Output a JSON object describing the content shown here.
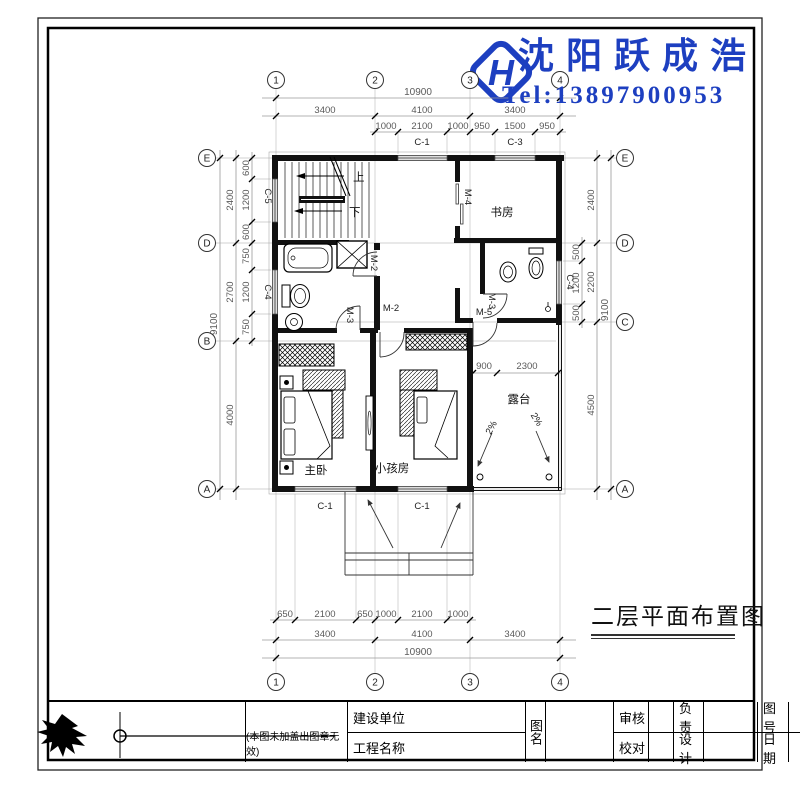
{
  "brand": {
    "name": "沈阳跃成浩",
    "tel": "Tel:13897900953",
    "logo_letter": "H"
  },
  "drawing_title": "二层平面布置图",
  "axes": {
    "cols": [
      "1",
      "2",
      "3",
      "4"
    ],
    "rows_left": [
      "E",
      "D",
      "B",
      "A"
    ],
    "rows_right": [
      "E",
      "D",
      "C",
      "A"
    ]
  },
  "dims": {
    "top": {
      "overall": "10900",
      "spans": [
        "3400",
        "4100",
        "3400"
      ],
      "details": [
        "1000",
        "2100",
        "1000",
        "950",
        "1500",
        "950"
      ]
    },
    "bottom": {
      "overall": "10900",
      "spans": [
        "3400",
        "4100",
        "3400"
      ],
      "details": [
        "650",
        "2100",
        "650",
        "1000",
        "2100",
        "1000"
      ]
    },
    "left": {
      "overall": "9100",
      "spans": [
        "2400",
        "2700",
        "4000"
      ],
      "details": [
        "600",
        "1200",
        "600",
        "750",
        "1200",
        "750"
      ]
    },
    "right": {
      "overall": "9100",
      "spans": [
        "2400",
        "2200",
        "4500"
      ],
      "details": [
        "500",
        "1200",
        "500"
      ]
    },
    "terrace": [
      "900",
      "2300"
    ]
  },
  "windows": {
    "c1": "C-1",
    "c3": "C-3",
    "c4": "C-4",
    "c5": "C-5"
  },
  "doors": {
    "m2": "M-2",
    "m3": "M-3",
    "m4": "M-4",
    "m5": "M-5"
  },
  "rooms": {
    "study": "书房",
    "master": "主卧",
    "kids": "小孩房",
    "terrace": "露台"
  },
  "stair": {
    "up": "上",
    "down": "下"
  },
  "slope": "2%",
  "titleblock": {
    "note": "(本图未加盖出图章无效)",
    "owner": "建设单位",
    "project": "工程名称",
    "sheet_name": "图名",
    "review": "审核",
    "check": "校对",
    "charge": "负责",
    "design": "设计",
    "sheet_no": "图号",
    "date": "日期"
  }
}
